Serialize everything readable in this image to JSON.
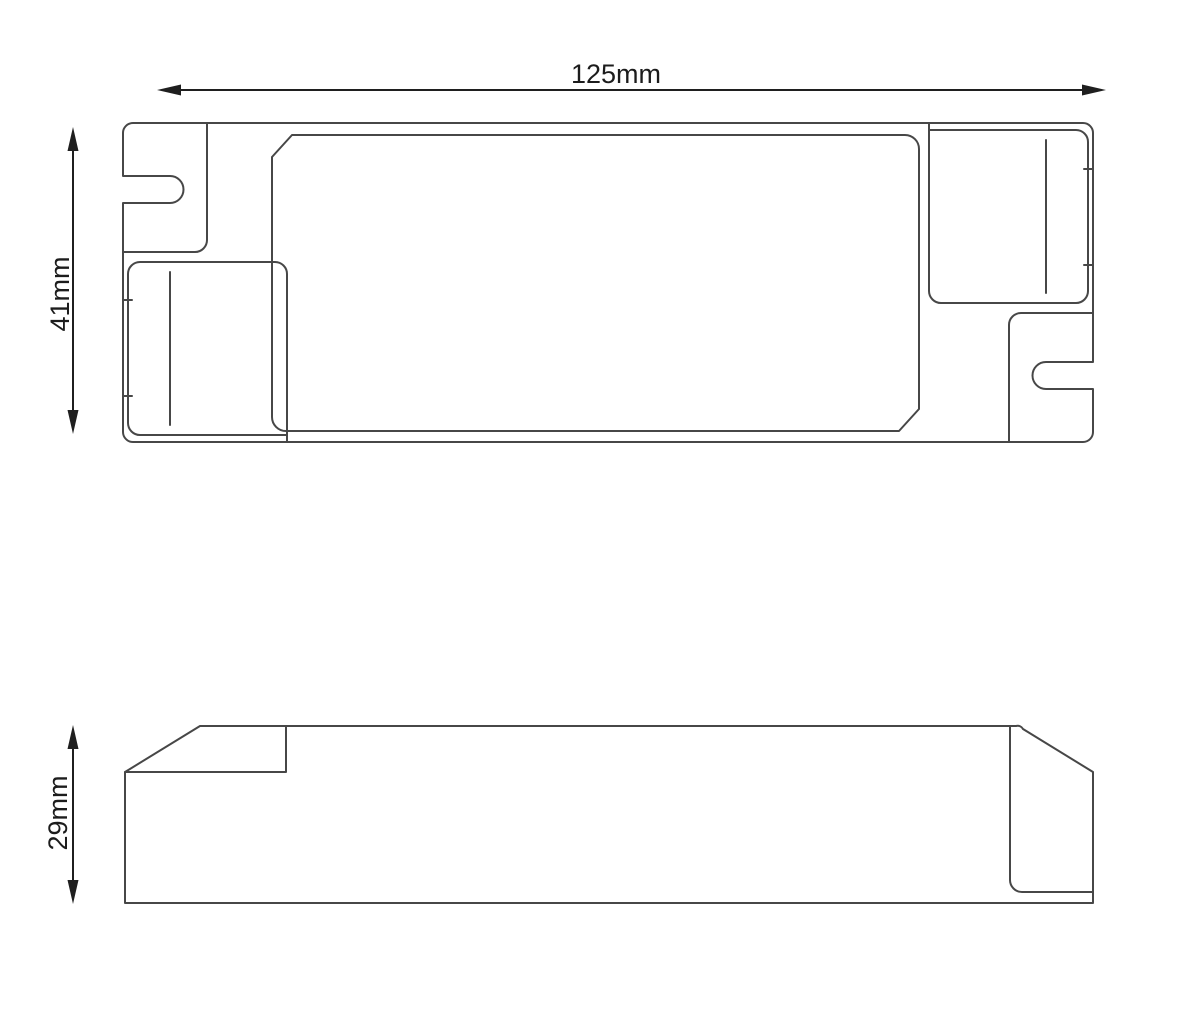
{
  "dimensions": {
    "length_label": "125mm",
    "width_label": "41mm",
    "height_label": "29mm"
  },
  "colors": {
    "background": "#ffffff",
    "outline": "#474747",
    "dimension_line": "#1f1f1f",
    "label_text": "#1c1c1c"
  }
}
